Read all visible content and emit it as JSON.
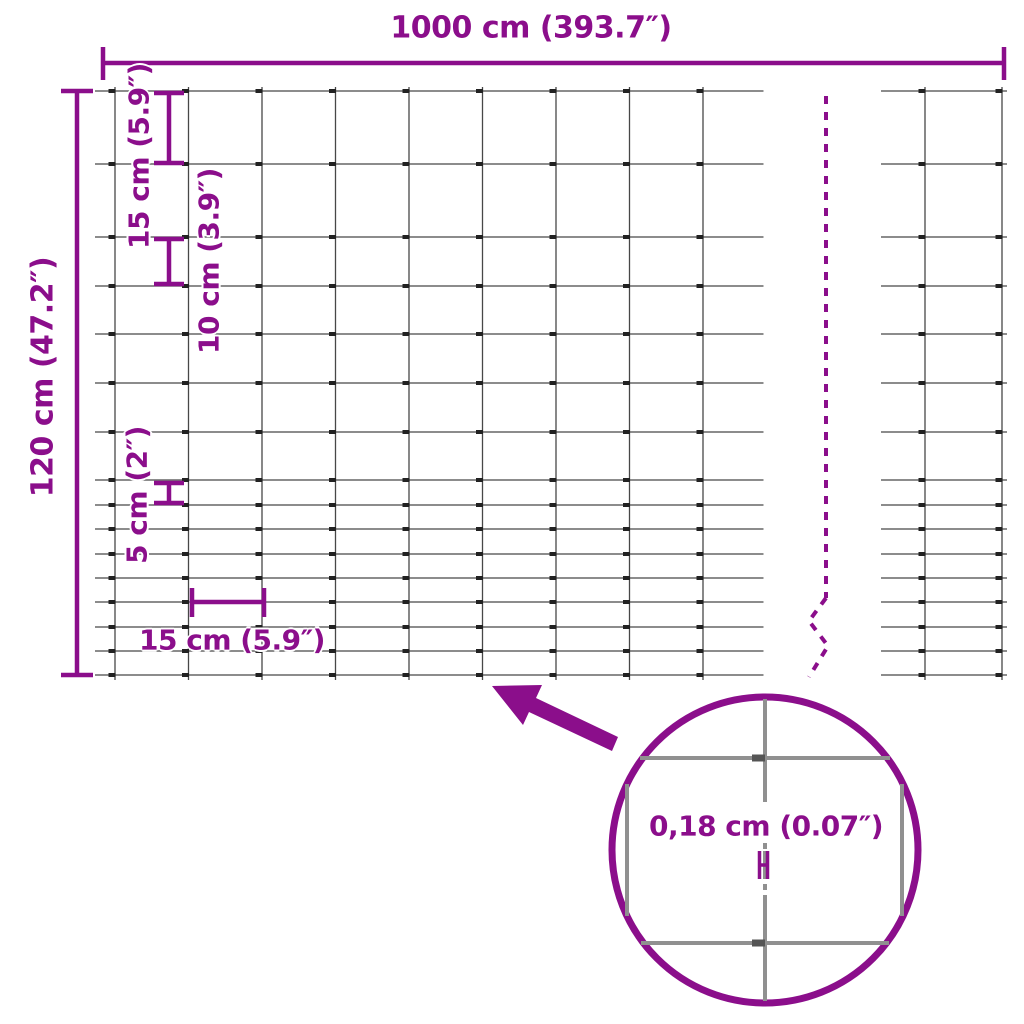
{
  "labels": {
    "total_width": "1000 cm (393.7″)",
    "total_height": "120 cm (47.2″)",
    "row_spacing_15": "15 cm (5.9″)",
    "row_spacing_10": "10 cm (3.9″)",
    "row_spacing_5": "5 cm (2″)",
    "column_spacing": "15 cm (5.9″)",
    "wire_thickness": "0,18 cm (0.07″)"
  },
  "mesh": {
    "total_width_cm": 1000,
    "total_height_cm": 120,
    "column_gap_cm": 15,
    "wire_thickness_cm": 0.18,
    "row_gaps_cm_top_to_bottom": [
      15,
      15,
      10,
      10,
      10,
      10,
      10,
      5,
      5,
      5,
      5,
      5,
      5,
      5,
      5
    ]
  },
  "colors": {
    "accent": "#8B0E8B",
    "wire": "#474747",
    "clamp": "#222222",
    "zoom_wire": "#909090",
    "zoom_clamp": "#555555"
  }
}
